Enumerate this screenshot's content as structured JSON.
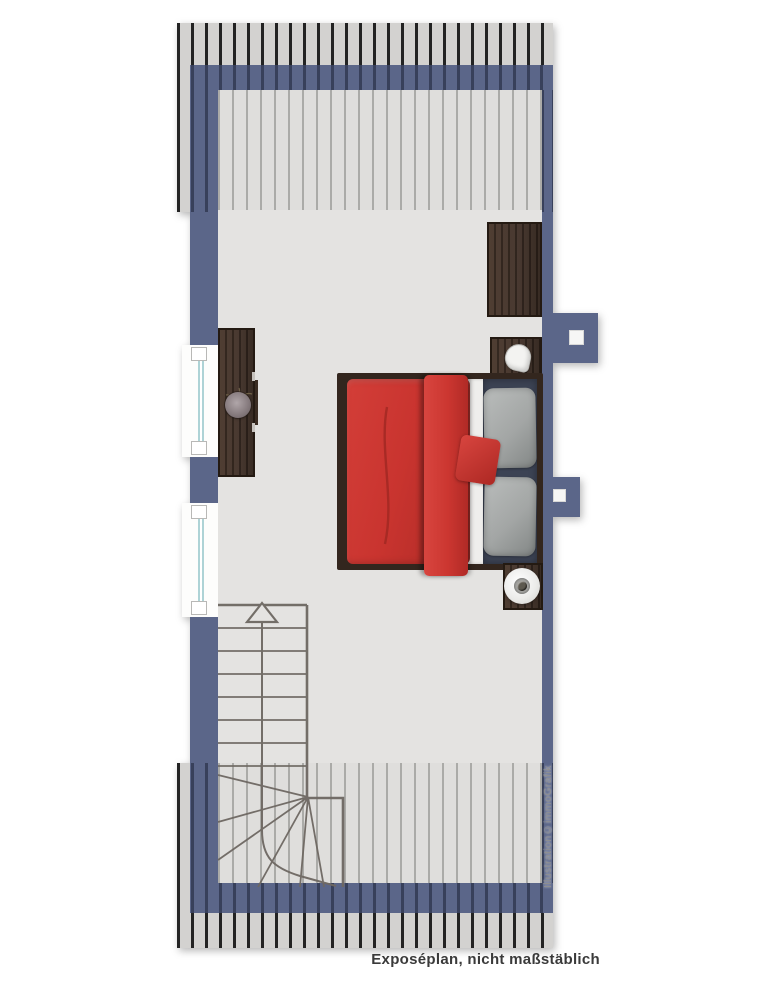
{
  "caption": {
    "text": "Exposéplan, nicht maßstäblich"
  },
  "credit": {
    "text": "Illustration©immoGrafik"
  },
  "colors": {
    "wall": "#5b6689",
    "floor": "#e4e3e1",
    "hatch_outer_bg": "#d3d2d0",
    "hatch_line_dark": "#232323",
    "hatch_inner_bg": "#dfdedc",
    "hatch_line_light": "#ababa8",
    "wood_dark": "#3f2f25",
    "bed_red": "#c9342f",
    "mattress_navy": "#3c4354",
    "pillow_gray": "#a3a6a5",
    "stair_line": "#6e6862",
    "window_glass": "#aed3d6",
    "text_dark": "#3a3a3a",
    "text_light": "#8f8f8f"
  }
}
